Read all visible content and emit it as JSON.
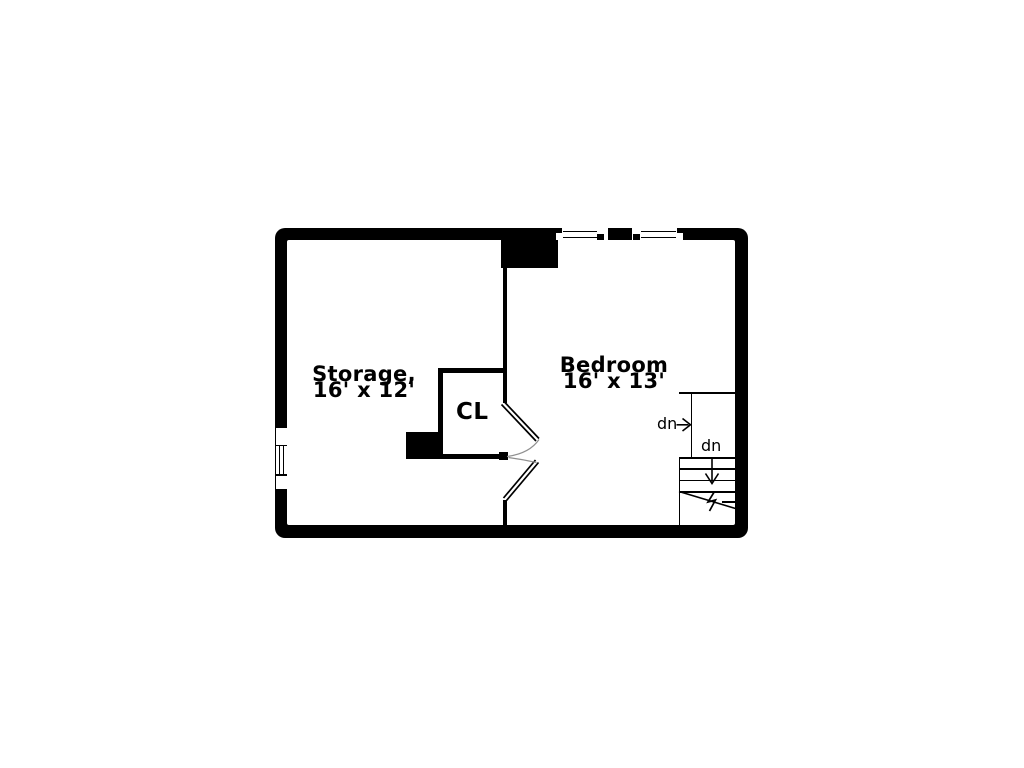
{
  "plan": {
    "storage": {
      "name": "Storage,",
      "dims": "16' x 12'"
    },
    "bedroom": {
      "name": "Bedroom",
      "dims": "16' x 13'"
    },
    "closet": {
      "label": "CL"
    },
    "stairs": {
      "upper_dn": "dn",
      "lower_dn": "dn"
    },
    "colors": {
      "wall": "#000000",
      "floor": "#ffffff",
      "door_arc": "#909090"
    }
  }
}
